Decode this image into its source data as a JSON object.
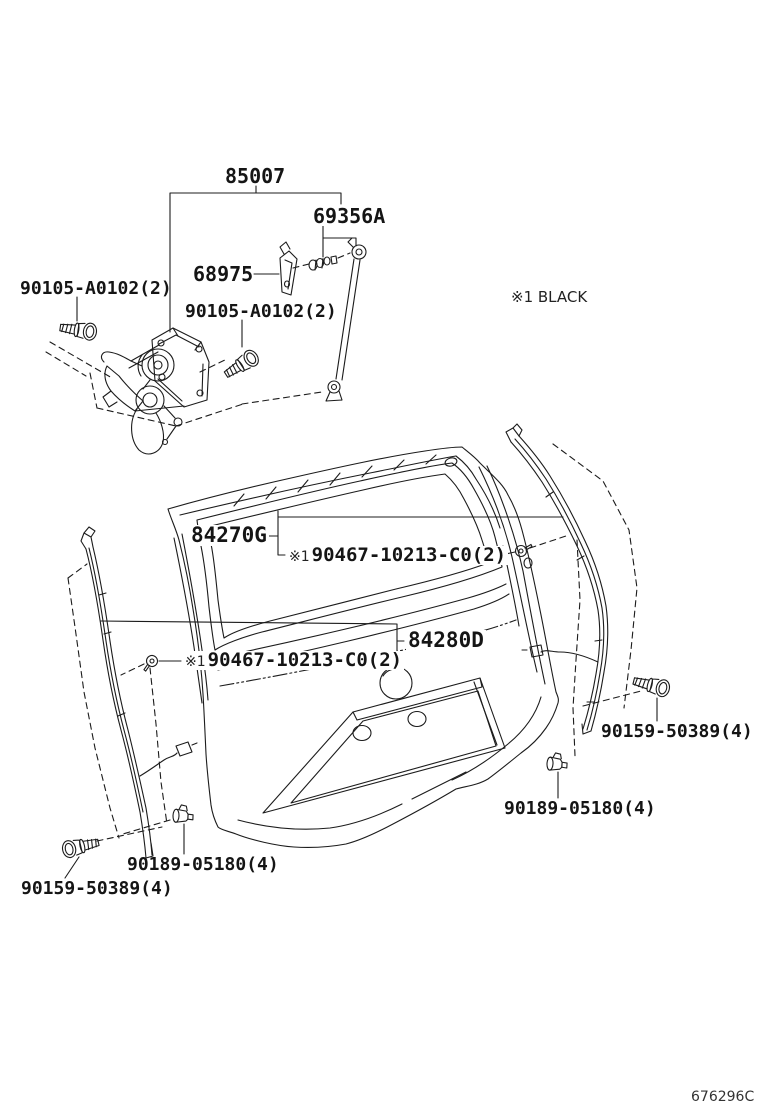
{
  "page": {
    "background": "#ffffff",
    "ink": "#1c1c1c",
    "note": "※1 BLACK",
    "sheet_code": "676296C"
  },
  "labels": {
    "wiper_motor_assembly": "85007",
    "back_door_stay": "69356A",
    "stay_bracket": "68975",
    "bolt_upper_left": "90105-A0102(2)",
    "bolt_upper_center": "90105-A0102(2)",
    "garnish_right": "84270G",
    "garnish_left": "84280D",
    "clip_right": {
      "prefix": "※1",
      "number": "90467-10213-C0(2)"
    },
    "clip_left": {
      "prefix": "※1",
      "number": "90467-10213-C0(2)"
    },
    "screw_lower_right": "90159-50389(4)",
    "grommet_lower_right": "90189-05180(4)",
    "grommet_lower_left": "90189-05180(4)",
    "screw_lower_left": "90159-50389(4)"
  }
}
